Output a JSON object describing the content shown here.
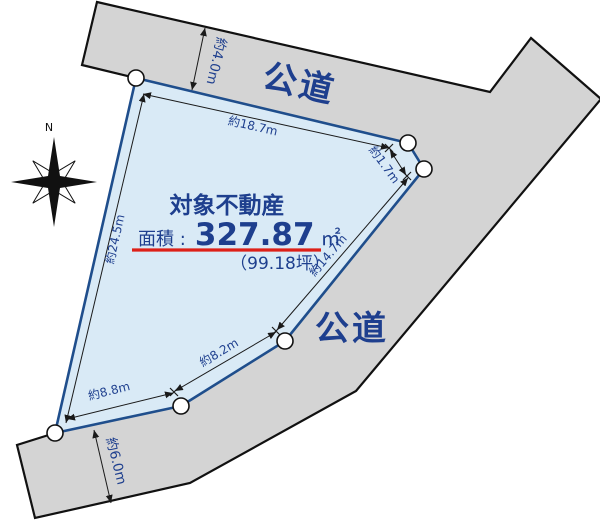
{
  "diagram": {
    "compass": {
      "north_label": "N"
    },
    "roads": {
      "top_label": "公道",
      "side_label": "公道"
    },
    "property": {
      "title": "対象不動産",
      "area_label": "面積 :",
      "area_value": "327.87",
      "area_unit": "㎡",
      "area_tsubo": "（99.18坪）"
    },
    "dimensions": {
      "top_edge": "約18.7m",
      "corner_edge": "約1.7m",
      "right_edge": "約14.7m",
      "lower_right_edge": "約8.2m",
      "bottom_edge": "約8.8m",
      "left_edge": "約24.5m",
      "top_road_width": "約4.0m",
      "bottom_road_width": "約6.0m"
    },
    "colors": {
      "navy_text": "#1e3f8e",
      "plot_fill": "#d9eaf6",
      "plot_stroke": "#1f4e8c",
      "road_fill": "#d4d4d4",
      "underline_red": "#dd2018",
      "outline_black": "#111111"
    }
  }
}
